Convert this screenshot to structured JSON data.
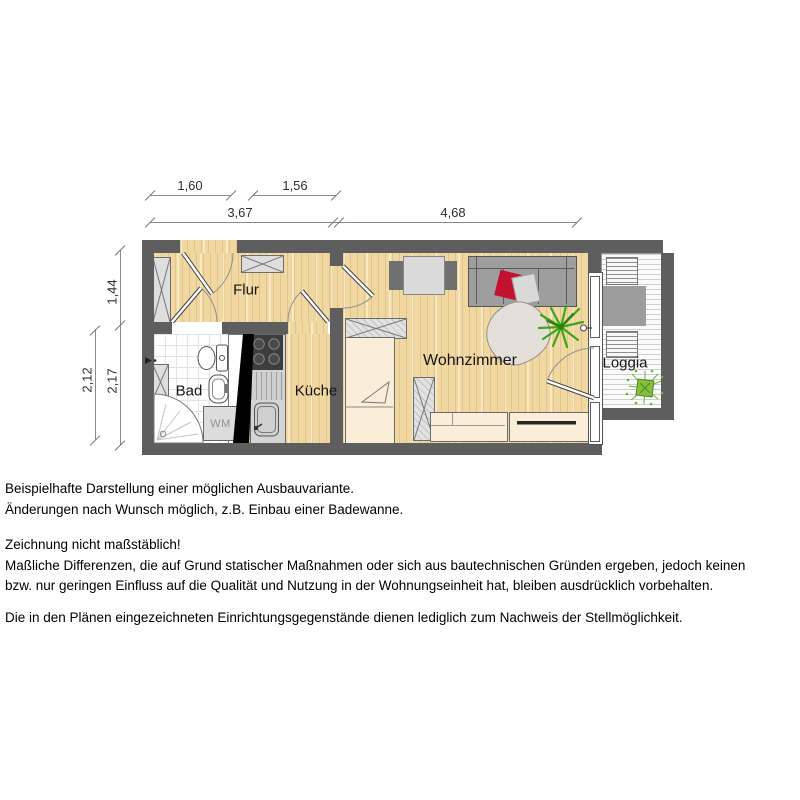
{
  "colors": {
    "wall_gray": "#5e5e5e",
    "wood_floor": "#f1d8a2",
    "furniture_cream": "#fbeed8",
    "sofa_gray": "#9e9e9e",
    "pillow_red": "#c2122f",
    "plant_green": "#3aa618",
    "shaft_black": "#000000"
  },
  "plan": {
    "rooms": [
      {
        "id": "flur",
        "label": "Flur"
      },
      {
        "id": "bad",
        "label": "Bad"
      },
      {
        "id": "kueche",
        "label": "Küche"
      },
      {
        "id": "wohnzimmer",
        "label": "Wohnzimmer"
      },
      {
        "id": "loggia",
        "label": "Loggia"
      }
    ],
    "appliance_labels": {
      "washing_machine": "WM"
    },
    "dimensions": {
      "top_row_1": [
        {
          "value": "1,60"
        },
        {
          "value": "1,56"
        }
      ],
      "top_row_2": [
        {
          "value": "3,67"
        },
        {
          "value": "4,68"
        }
      ],
      "left_inner": [
        {
          "value": "1,44"
        },
        {
          "value": "2,17"
        }
      ],
      "left_outer": [
        {
          "value": "2,12"
        }
      ]
    }
  },
  "notes": {
    "para1": [
      "Beispielhafte Darstellung einer möglichen Ausbauvariante.",
      "Änderungen nach Wunsch möglich, z.B. Einbau einer Badewanne."
    ],
    "para2": [
      "Zeichnung nicht maßstäblich!",
      "Maßliche Differenzen, die auf Grund statischer Maßnahmen oder sich aus bautechnischen Gründen ergeben, jedoch keinen",
      "bzw. nur geringen Einfluss auf die Qualität und Nutzung in der Wohnungseinheit hat, bleiben ausdrücklich vorbehalten."
    ],
    "para3": [
      "Die in den Plänen eingezeichneten Einrichtungsgegenstände dienen lediglich zum Nachweis der Stellmöglichkeit."
    ]
  }
}
